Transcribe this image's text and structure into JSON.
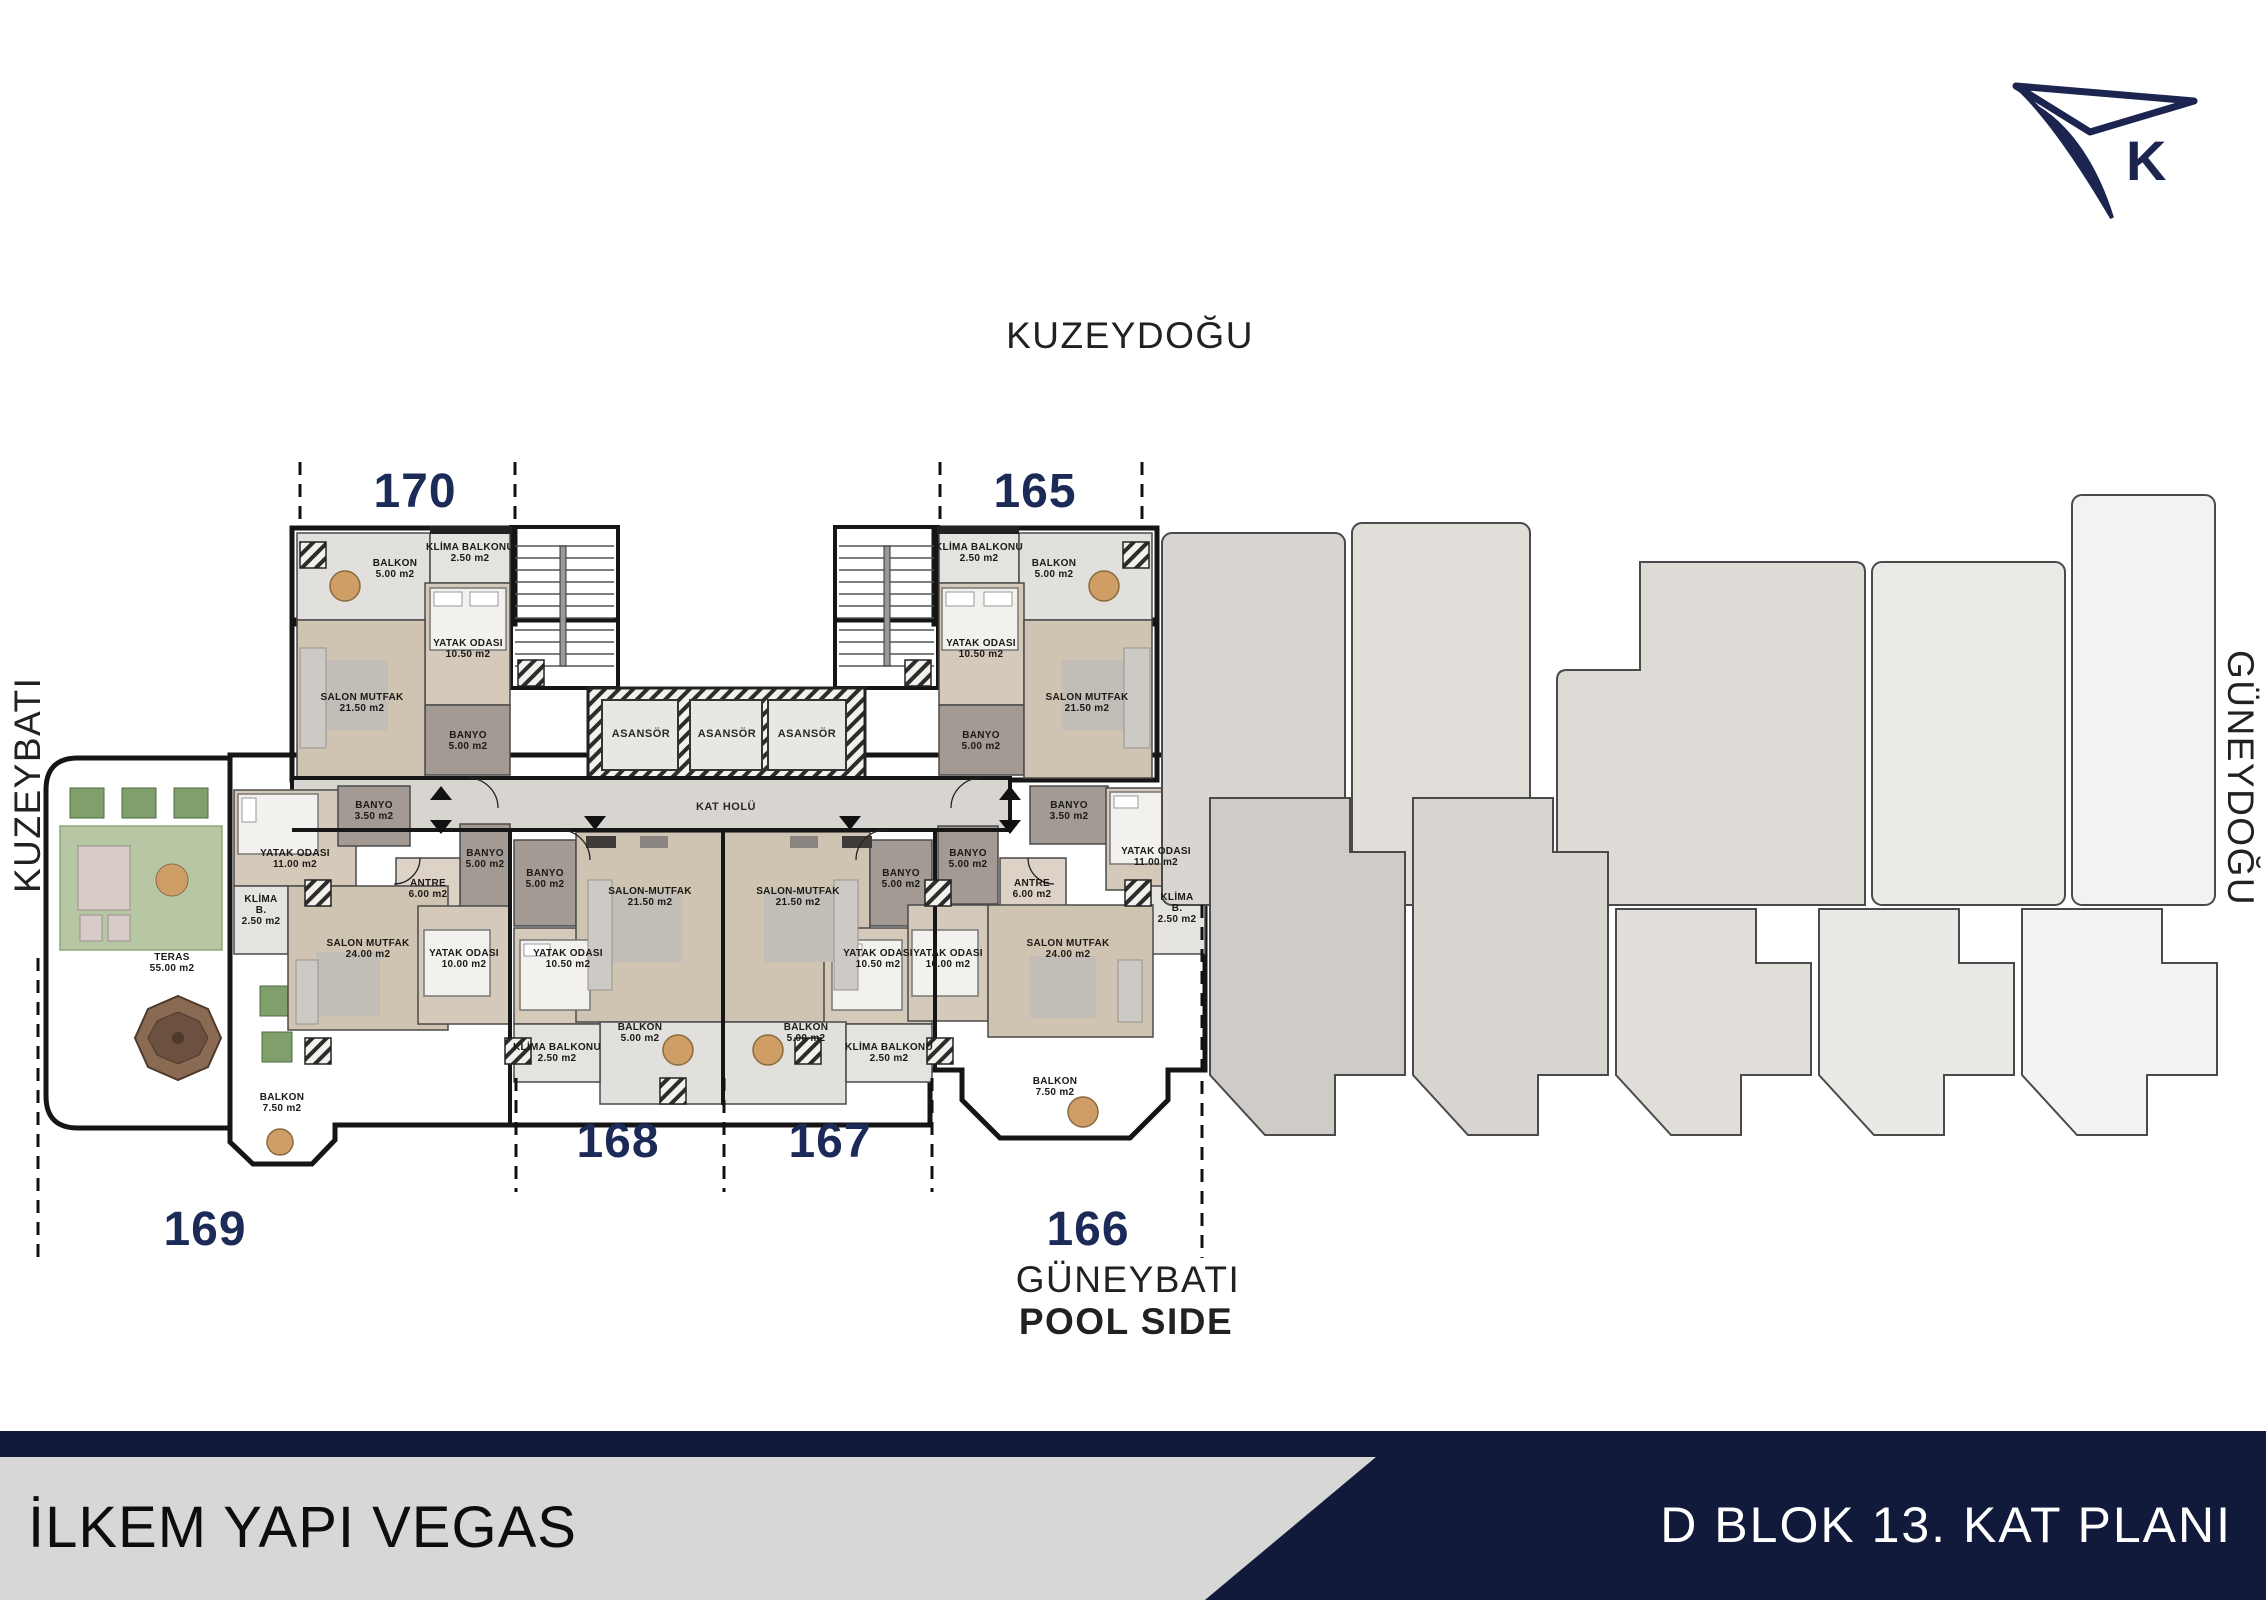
{
  "title_bar": {
    "project": "İLKEM YAPI VEGAS",
    "plan": "D BLOK 13. KAT PLANI"
  },
  "compass": {
    "label": "K"
  },
  "directions": {
    "top": "KUZEYDOĞU",
    "left": "KUZEYBATI",
    "right": "GÜNEYDOĞU",
    "bottom": "GÜNEYBATI",
    "bottom_sub": "POOL SIDE"
  },
  "colors": {
    "navy_accent": "#1B2550",
    "unit_number": "#1C2A57",
    "banner_navy": "#111A3B",
    "banner_gray": "#D7D7D5",
    "floor": "#EDEBE8",
    "wood_room": "#D5CABA",
    "bathroom": "#A39A93",
    "grass": "#B7C6A3"
  },
  "units": [
    {
      "n": "170",
      "x": 415,
      "y": 507
    },
    {
      "n": "165",
      "x": 1035,
      "y": 507
    },
    {
      "n": "168",
      "x": 618,
      "y": 1157
    },
    {
      "n": "167",
      "x": 830,
      "y": 1157
    },
    {
      "n": "169",
      "x": 205,
      "y": 1245
    },
    {
      "n": "166",
      "x": 1088,
      "y": 1245
    }
  ],
  "core_labels": [
    {
      "id": "asansor-1",
      "lines": [
        "ASANSÖR"
      ],
      "x": 641,
      "y": 737
    },
    {
      "id": "asansor-2",
      "lines": [
        "ASANSÖR"
      ],
      "x": 727,
      "y": 737
    },
    {
      "id": "asansor-3",
      "lines": [
        "ASANSÖR"
      ],
      "x": 807,
      "y": 737
    },
    {
      "id": "kat-holu",
      "lines": [
        "KAT HOLÜ"
      ],
      "x": 726,
      "y": 810
    }
  ],
  "rooms": [
    {
      "id": "balkon-170",
      "lines": [
        "BALKON",
        "5.00 m2"
      ],
      "x": 395,
      "y": 566
    },
    {
      "id": "klima-balkonu-170",
      "lines": [
        "KLİMA BALKONU",
        "2.50 m2"
      ],
      "x": 470,
      "y": 550
    },
    {
      "id": "yatak-odasi-170",
      "lines": [
        "YATAK ODASI",
        "10.50 m2"
      ],
      "x": 468,
      "y": 646
    },
    {
      "id": "salon-mutfak-170",
      "lines": [
        "SALON MUTFAK",
        "21.50 m2"
      ],
      "x": 362,
      "y": 700
    },
    {
      "id": "banyo-170",
      "lines": [
        "BANYO",
        "5.00 m2"
      ],
      "x": 468,
      "y": 738
    },
    {
      "id": "klima-balkonu-165",
      "lines": [
        "KLİMA BALKONU",
        "2.50 m2"
      ],
      "x": 979,
      "y": 550
    },
    {
      "id": "balkon-165",
      "lines": [
        "BALKON",
        "5.00 m2"
      ],
      "x": 1054,
      "y": 566
    },
    {
      "id": "yatak-odasi-165",
      "lines": [
        "YATAK ODASI",
        "10.50 m2"
      ],
      "x": 981,
      "y": 646
    },
    {
      "id": "salon-mutfak-165",
      "lines": [
        "SALON MUTFAK",
        "21.50 m2"
      ],
      "x": 1087,
      "y": 700
    },
    {
      "id": "banyo-165",
      "lines": [
        "BANYO",
        "5.00 m2"
      ],
      "x": 981,
      "y": 738
    },
    {
      "id": "teras-169",
      "lines": [
        "TERAS",
        "55.00 m2"
      ],
      "x": 172,
      "y": 960
    },
    {
      "id": "yatak-odasi-169a",
      "lines": [
        "YATAK ODASI",
        "11.00 m2"
      ],
      "x": 295,
      "y": 856
    },
    {
      "id": "banyo-169a",
      "lines": [
        "BANYO",
        "3.50 m2"
      ],
      "x": 374,
      "y": 808
    },
    {
      "id": "banyo-169b",
      "lines": [
        "BANYO",
        "5.00 m2"
      ],
      "x": 485,
      "y": 856
    },
    {
      "id": "antre-169",
      "lines": [
        "ANTRE",
        "6.00 m2"
      ],
      "x": 428,
      "y": 886
    },
    {
      "id": "klima-b-169",
      "lines": [
        "KLİMA",
        "B.",
        "2.50 m2"
      ],
      "x": 261,
      "y": 902
    },
    {
      "id": "salon-mutfak-169",
      "lines": [
        "SALON MUTFAK",
        "24.00 m2"
      ],
      "x": 368,
      "y": 946
    },
    {
      "id": "yatak-odasi-169b",
      "lines": [
        "YATAK ODASI",
        "10.00 m2"
      ],
      "x": 464,
      "y": 956
    },
    {
      "id": "balkon-169",
      "lines": [
        "BALKON",
        "7.50 m2"
      ],
      "x": 282,
      "y": 1100
    },
    {
      "id": "banyo-168",
      "lines": [
        "BANYO",
        "5.00 m2"
      ],
      "x": 545,
      "y": 876
    },
    {
      "id": "yatak-odasi-168",
      "lines": [
        "YATAK ODASI",
        "10.50 m2"
      ],
      "x": 568,
      "y": 956
    },
    {
      "id": "salon-mutfak-168",
      "lines": [
        "SALON-MUTFAK",
        "21.50 m2"
      ],
      "x": 650,
      "y": 894
    },
    {
      "id": "balkon-168",
      "lines": [
        "BALKON",
        "5.00 m2"
      ],
      "x": 640,
      "y": 1030
    },
    {
      "id": "klima-balkonu-168",
      "lines": [
        "KLİMA BALKONU",
        "2.50 m2"
      ],
      "x": 557,
      "y": 1050
    },
    {
      "id": "salon-mutfak-167",
      "lines": [
        "SALON-MUTFAK",
        "21.50 m2"
      ],
      "x": 798,
      "y": 894
    },
    {
      "id": "yatak-odasi-167",
      "lines": [
        "YATAK ODASI",
        "10.50 m2"
      ],
      "x": 878,
      "y": 956
    },
    {
      "id": "banyo-167",
      "lines": [
        "BANYO",
        "5.00 m2"
      ],
      "x": 901,
      "y": 876
    },
    {
      "id": "balkon-167",
      "lines": [
        "BALKON",
        "5.00 m2"
      ],
      "x": 806,
      "y": 1030
    },
    {
      "id": "klima-balkonu-167",
      "lines": [
        "KLİMA BALKONU",
        "2.50 m2"
      ],
      "x": 889,
      "y": 1050
    },
    {
      "id": "banyo-166a",
      "lines": [
        "BANYO",
        "3.50 m2"
      ],
      "x": 1069,
      "y": 808
    },
    {
      "id": "yatak-odasi-166a",
      "lines": [
        "YATAK ODASI",
        "11.00 m2"
      ],
      "x": 1156,
      "y": 854
    },
    {
      "id": "banyo-166b",
      "lines": [
        "BANYO",
        "5.00 m2"
      ],
      "x": 968,
      "y": 856
    },
    {
      "id": "antre-166",
      "lines": [
        "ANTRE",
        "6.00 m2"
      ],
      "x": 1032,
      "y": 886
    },
    {
      "id": "klima-b-166",
      "lines": [
        "KLİMA",
        "B.",
        "2.50 m2"
      ],
      "x": 1177,
      "y": 900
    },
    {
      "id": "yatak-odasi-166b",
      "lines": [
        "YATAK ODASI",
        "10.00 m2"
      ],
      "x": 948,
      "y": 956
    },
    {
      "id": "salon-mutfak-166",
      "lines": [
        "SALON MUTFAK",
        "24.00 m2"
      ],
      "x": 1068,
      "y": 946
    },
    {
      "id": "balkon-166",
      "lines": [
        "BALKON",
        "7.50 m2"
      ],
      "x": 1055,
      "y": 1084
    }
  ]
}
